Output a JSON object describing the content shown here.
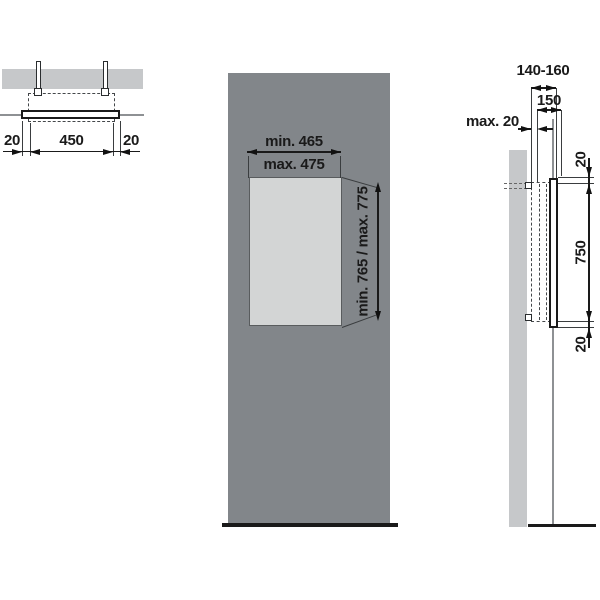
{
  "drawing_title": "Mirror recessed installation dimensions",
  "colors": {
    "panel_gray": "#82868a",
    "niche_gray": "#d3d5d5",
    "wall_gray": "#c6c8ca",
    "line_black": "#1a1a1a",
    "line_gray": "#8e9194"
  },
  "top_view": {
    "dim_left": "20",
    "dim_width": "450",
    "dim_right": "20"
  },
  "front_view": {
    "width_line1": "min. 465",
    "width_line2": "max. 475",
    "height_label": "min. 765 / max. 775"
  },
  "side_view": {
    "depth_range": "140-160",
    "depth_mid": "150",
    "wall_offset": "max. 20",
    "gap_top": "20",
    "height_mid": "750",
    "gap_bottom": "20"
  }
}
